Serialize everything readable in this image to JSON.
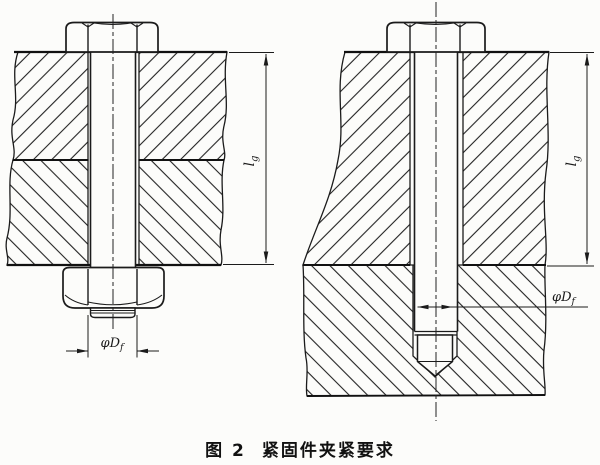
{
  "caption": {
    "figure_number": "图 2",
    "title": "紧固件夹紧要求"
  },
  "dimensions": {
    "grip_length": {
      "symbol": "l",
      "subscript": "g"
    },
    "hole_diameter": {
      "prefix": "φ",
      "symbol": "D",
      "subscript": "f"
    }
  },
  "colors": {
    "line": "#1b1b1b",
    "paper": "#fcfcfa"
  }
}
